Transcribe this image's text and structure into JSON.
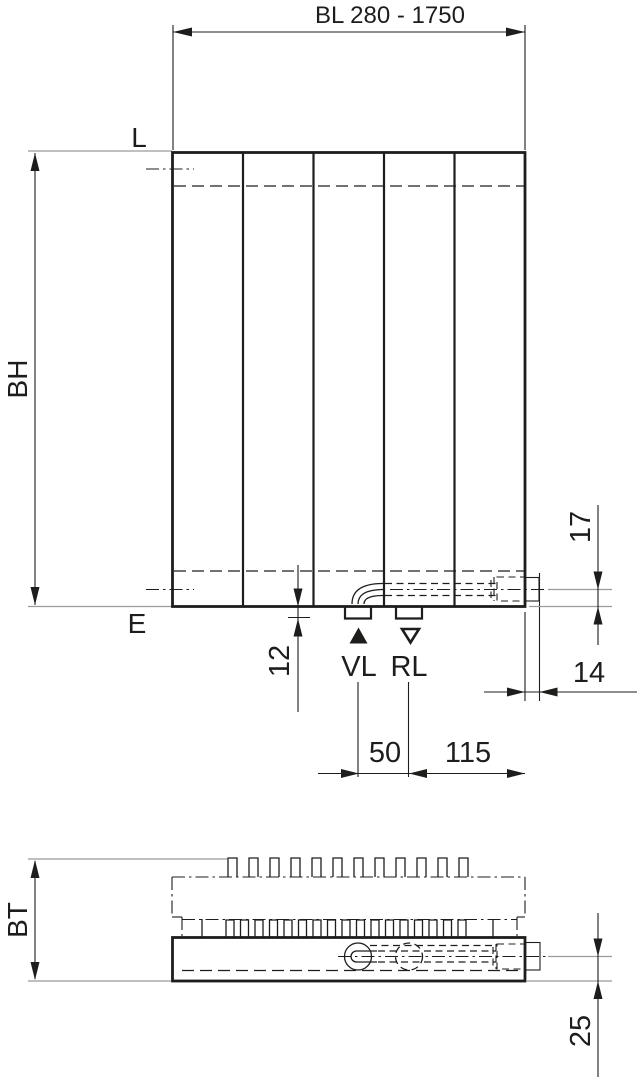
{
  "front_view": {
    "width_dim_label": "BL 280 - 1750",
    "top_edge_label": "L",
    "bottom_edge_label": "E",
    "height_dim_label": "BH",
    "tab_offset_dim": "12",
    "pipe_height_dim": "17",
    "valve_protrusion_dim": "14",
    "supply_label": "VL",
    "return_label": "RL",
    "supply_return_spacing_dim": "50",
    "return_to_edge_spacing_dim": "115"
  },
  "bottom_view": {
    "depth_dim_label": "BT",
    "pipe_depth_dim": "25"
  },
  "icons": {
    "supply_marker": "filled-triangle-up",
    "return_marker": "open-triangle-down"
  },
  "colors": {
    "line": "#1d1d1b",
    "extension_line": "#9b9b9b",
    "background": "#ffffff"
  }
}
